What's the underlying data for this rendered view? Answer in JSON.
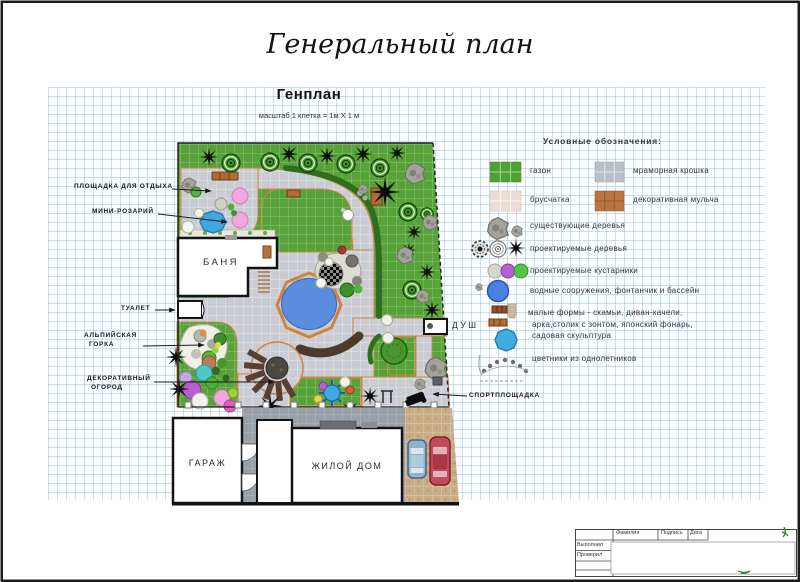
{
  "page": {
    "title": "Генеральный план"
  },
  "plan": {
    "heading": "Генплан",
    "scale_note": "масштаб 1 клетка = 1м X 1 м"
  },
  "site": {
    "rest_area": "ПЛОЩАДКА ДЛЯ ОТДЫХА",
    "mini_rosary": "МИНИ-РОЗАРИЙ",
    "toilet": "ТУАЛЕТ",
    "alpine_line1": "АЛЬПИЙСКАЯ",
    "alpine_line2": "ГОРКА",
    "veg_line1": "ДЕКОРАТИВНЫЙ",
    "veg_line2": "ОГОРОД",
    "bathhouse": "БАНЯ",
    "shower": "ДУШ",
    "sport": "СПОРТПЛОЩАДКА",
    "garage": "ГАРАЖ",
    "house": "ЖИЛОЙ ДОМ"
  },
  "legend": {
    "title": "Условные обозначения:",
    "lawn": "газон",
    "marble": "мраморная крошка",
    "pavers": "брусчатка",
    "mulch": "декоративная мульча",
    "existing_trees": "существующие деревья",
    "planned_trees": "проектируемые деревья",
    "planned_shrubs": "проектируемые кустарники",
    "water": "водные сооружения, фонтанчик и бассейн",
    "small_forms_line1": "малые формы - скамьи, диван-качели,",
    "small_forms_line2": "арка,столик с зонтом, японский фонарь,",
    "small_forms_line3": "садовая скульптура",
    "annual_flowers": "цветники из однолетников"
  },
  "titleblock": {
    "surname": "Фамилия",
    "signature": "Подпись",
    "date": "Дата",
    "executed": "Выполнил",
    "checked": "Проверил"
  },
  "colors": {
    "lawn": "#57a339",
    "path": "#c9ccd2",
    "edging": "#cf8448",
    "pool": "#5b8dde",
    "hedge": "#2f6e1e",
    "grid": "#9ec4e4"
  }
}
